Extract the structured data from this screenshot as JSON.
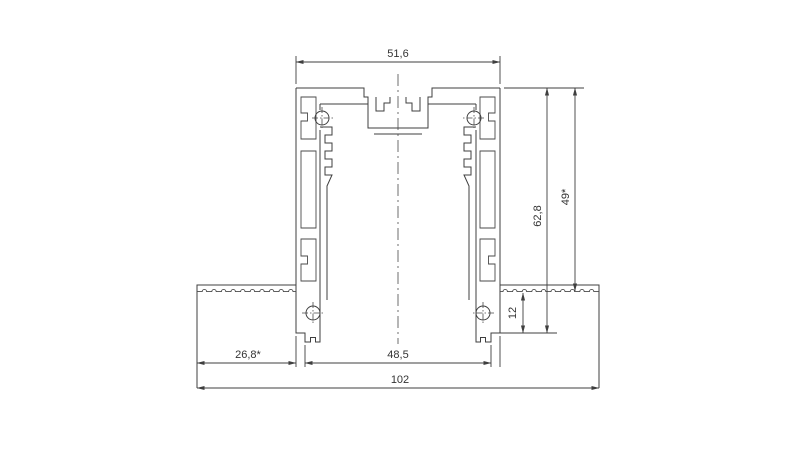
{
  "drawing": {
    "kind": "aluminium-extrusion-cross-section",
    "colors": {
      "line": "#3f3f3f",
      "text": "#333333",
      "background": "#ffffff"
    },
    "dimensions": {
      "top_width": "51,6",
      "inner_height": "49*",
      "overall_height": "62,8",
      "flange_thickness": "12",
      "wing_width": "26,8*",
      "bottom_body_width": "48,5",
      "total_width": "102"
    }
  }
}
